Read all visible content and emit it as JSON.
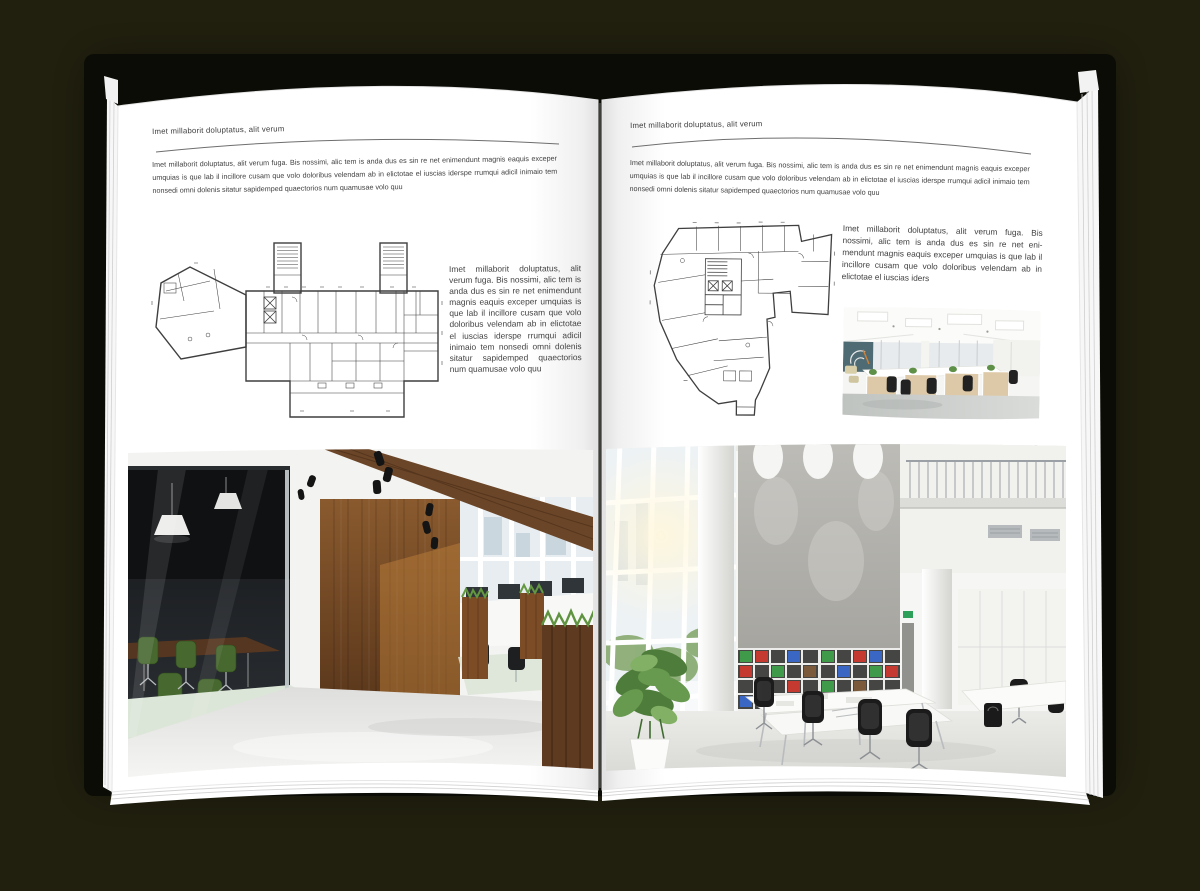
{
  "scene": {
    "background_color": "#21200f",
    "cover_color": "#0c0c06",
    "paper_color": "#ffffff",
    "text_color": "#3c3c3c",
    "rule_color": "#6e6e6e",
    "plan_line_color": "#3f3f3f",
    "wood_color": "#6b4527",
    "chair_green": "#47682f",
    "binder_colors": [
      "#3f9b49",
      "#c43a31",
      "#3a66c4",
      "#7a5a3a"
    ]
  },
  "left": {
    "header": "Imet millaborit doluptatus, alit verum",
    "intro": "Imet millaborit doluptatus, alit verum fuga. Bis nossimi, alic tem is anda dus es sin re net enimendunt magnis eaquis exceper umquias is que lab il incillore cusam que volo doloribus velendam ab in elictotae el iuscias iderspe rrumqui adicil inimaio tem nonsedi omni dolenis sitatur sapidemped quaectorios num quamusae volo quu",
    "sidebar": "Imet millaborit doluptatus, alit verum fuga. Bis nossimi, alic tem is anda dus es sin re net enimendunt magnis eaquis exceper umquias is que lab il incillore cusam que volo doloribus velendam ab in elictotae el iuscias iderspe rrumqui adicil inimaio tem nonsedi omni dolenis sitatur sapidemped quaectorios num quamusae volo quu",
    "floor_plan": "elongated-building-floor-plan",
    "photo": "dark-loft-office-interior-photo"
  },
  "right": {
    "header": "Imet millaborit doluptatus, alit verum",
    "intro": "Imet millaborit doluptatus, alit verum fuga. Bis nossimi, alic tem is anda dus es sin re net enimendunt magnis eaquis exceper umquias is que lab il incillore cusam que volo doloribus velendam ab in elictotae el iuscias iderspe rrumqui adicil inimaio tem nonsedi omni dolenis sitatur sapidemped quaectorios num quamusae volo quu",
    "sidebar": "Imet millaborit doluptatus, alit verum fuga. Bis nossimi, alic tem is anda dus es sin re net eni-mendunt magnis eaquis exceper umquias is que lab il incillore cusam que volo doloribus velendam ab in elictotae el iuscias iders",
    "floor_plan": "irregular-building-floor-plan",
    "photo_small": "open-plan-office-photo",
    "photo": "white-atrium-office-interior-photo"
  }
}
